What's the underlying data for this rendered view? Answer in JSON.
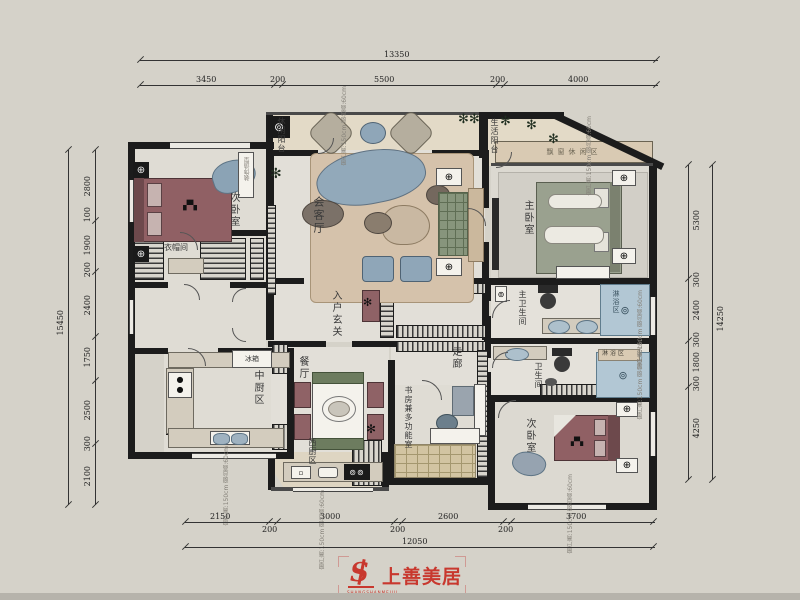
{
  "dimensions": {
    "top": {
      "total": "13350",
      "segments": [
        "3450",
        "200",
        "5500",
        "200",
        "4000"
      ]
    },
    "bottom": {
      "total": "12050",
      "segments": [
        "2150",
        "200",
        "3000",
        "200",
        "2600",
        "200",
        "3700"
      ]
    },
    "left": {
      "total": "15450",
      "segments": [
        "2800",
        "100",
        "1900",
        "200",
        "2400",
        "1750",
        "2500",
        "300",
        "2100"
      ]
    },
    "right": {
      "total": "14250",
      "segments": [
        "5300",
        "300",
        "2400",
        "300",
        "1800",
        "300",
        "4250"
      ]
    }
  },
  "rooms": {
    "living_room": "会客厅",
    "leisure_balcony": "休闲阳台",
    "life_balcony": "生活阳台",
    "master_bedroom": "主卧室",
    "second_bedroom_top": "次卧室",
    "second_bedroom_bottom": "次卧室",
    "cloakroom": "衣帽间",
    "chinese_kitchen": "中厨区",
    "western_kitchen": "西厨区",
    "dining_room": "餐厅",
    "entry_foyer": "入户玄关",
    "corridor": "走廊",
    "master_bathroom": "主卫生间",
    "bathroom": "卫生间",
    "shower_area_master": "淋浴区",
    "shower_area": "淋浴区",
    "study": "书房兼多功能室",
    "bay_window_seat": "飘窗休闲区",
    "fridge": "冰箱",
    "decor_feature": "装饰造型"
  },
  "annotations": {
    "window_note": "窗户高:150cm 窗台高:60cm"
  },
  "logo": {
    "brand": "上善美居",
    "subtext": "SHANGSHANMEIJU",
    "color": "#c8382e"
  }
}
